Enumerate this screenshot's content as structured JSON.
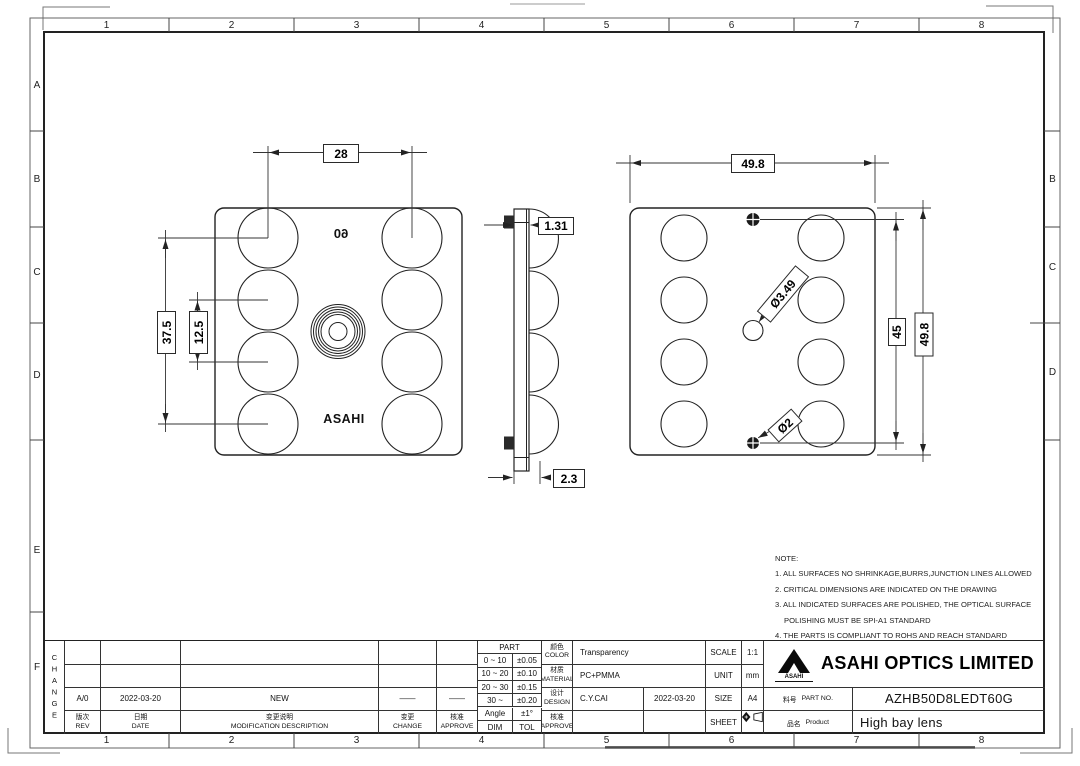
{
  "sheet": {
    "grid": {
      "columns": [
        "1",
        "2",
        "3",
        "4",
        "5",
        "6",
        "7",
        "8"
      ],
      "rows_left": [
        "A",
        "B",
        "C",
        "D",
        "E",
        "F"
      ],
      "rows_right": [
        "B",
        "C",
        "D"
      ]
    }
  },
  "front_view": {
    "marking_mirrored": "60",
    "marking_brand": "ASAHI",
    "dim_pitch_horizontal": "28",
    "dim_span_vertical": "37.5",
    "dim_pitch_vertical": "12.5"
  },
  "side_view": {
    "dim_thickness_top": "1.31",
    "dim_thickness_bottom": "2.3"
  },
  "back_view": {
    "dim_width": "49.8",
    "dim_pin_distance": "45",
    "dim_height": "49.8",
    "dim_center_hole": "Ø3.49",
    "dim_pin_diameter": "Ø2"
  },
  "notes": {
    "title": "NOTE:",
    "lines": [
      "1. ALL SURFACES NO SHRINKAGE,BURRS,JUNCTION LINES ALLOWED",
      "2. CRITICAL DIMENSIONS ARE INDICATED ON THE DRAWING",
      "3. ALL INDICATED SURFACES ARE POLISHED, THE OPTICAL SURFACE",
      "POLISHING MUST BE SPI-A1 STANDARD",
      "4. THE PARTS IS COMPLIANT TO ROHS AND REACH STANDARD"
    ]
  },
  "title_block": {
    "change_block": {
      "vertical_label": "CHANGE",
      "row_rev": "A/0",
      "row_date": "2022-03-20",
      "row_description": "NEW",
      "row_change_mark": "——",
      "row_approve_mark": "——",
      "header_rev_cn": "版次",
      "header_rev_en": "REV",
      "header_date_cn": "日期",
      "header_date_en": "DATE",
      "header_desc_cn": "变更说明",
      "header_desc_en": "MODIFICATION DESCRIPTION",
      "header_change_cn": "变更",
      "header_change_en": "CHANGE",
      "header_approve_cn": "核准",
      "header_approve_en": "APPROVE"
    },
    "tolerance_table": {
      "title": "PART",
      "rows": [
        [
          "0 ~ 10",
          "±0.05"
        ],
        [
          "10 ~ 20",
          "±0.10"
        ],
        [
          "20 ~ 30",
          "±0.15"
        ],
        [
          "30 ~",
          "±0.20"
        ],
        [
          "Angle",
          "±1°"
        ],
        [
          "DIM",
          "TOL"
        ]
      ]
    },
    "spec": {
      "color_cn": "颜色",
      "color_en": "COLOR",
      "color_value": "Transparency",
      "material_cn": "材质",
      "material_en": "MATERIAL",
      "material_value": "PC+PMMA",
      "design_cn": "设计",
      "design_en": "DESIGN",
      "design_by": "C.Y.CAI",
      "design_date": "2022-03-20",
      "approve_cn": "核准",
      "approve_en": "APPROVE"
    },
    "meta": {
      "scale_label": "SCALE",
      "scale_value": "1:1",
      "unit_label": "UNIT",
      "unit_value": "mm",
      "size_label": "SIZE",
      "size_value": "A4",
      "sheet_label": "SHEET"
    },
    "company": {
      "logo_caption": "ASAHI",
      "name": "ASAHI OPTICS LIMITED",
      "part_no_cn": "料号",
      "part_no_label": "PART NO.",
      "part_no_value": "AZHB50D8LEDT60G",
      "product_cn": "品名",
      "product_label": "Product",
      "product_value": "High bay lens"
    }
  }
}
